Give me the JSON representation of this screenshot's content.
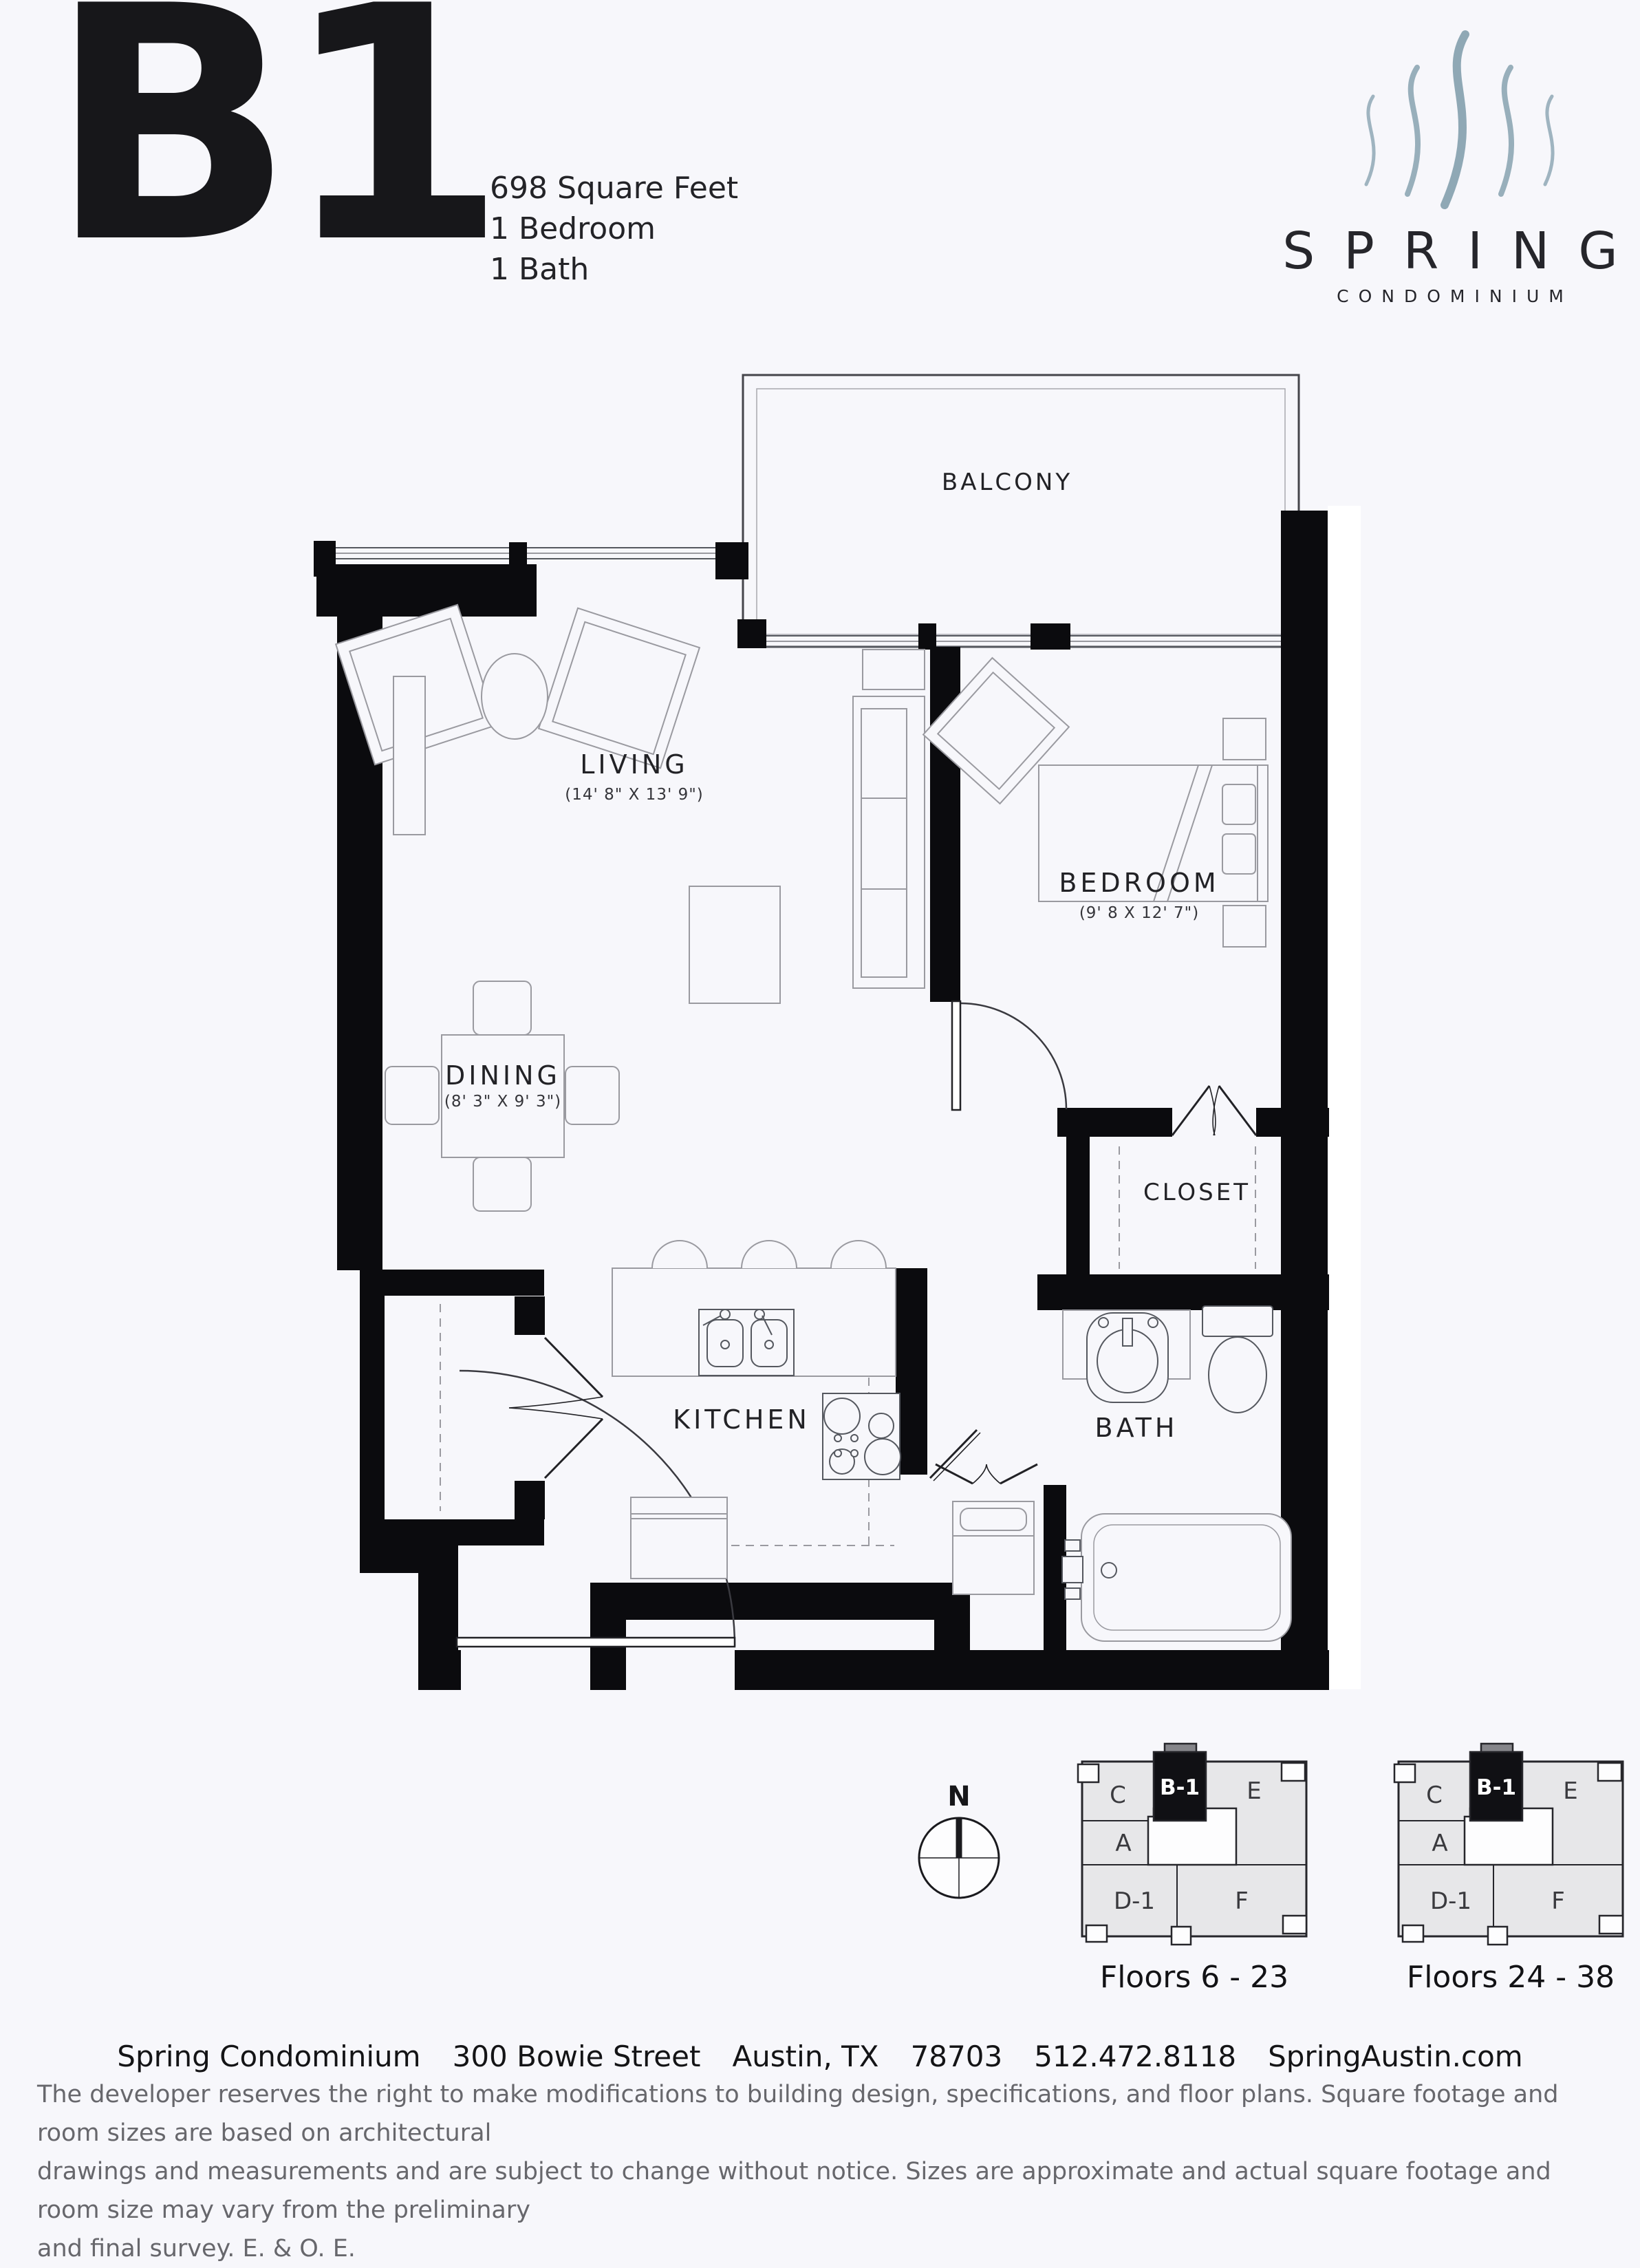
{
  "header": {
    "plan_code": "B1",
    "stats": [
      "698 Square Feet",
      "1 Bedroom",
      "1 Bath"
    ]
  },
  "logo": {
    "brand": "SPRING",
    "subtitle": "CONDOMINIUM",
    "wave_color": "#8fa8b5"
  },
  "floor_plan": {
    "rooms": [
      {
        "name": "BALCONY",
        "dims": ""
      },
      {
        "name": "LIVING",
        "dims": "(14' 8\" X 13' 9\")"
      },
      {
        "name": "BEDROOM",
        "dims": "(9' 8 X 12' 7\")"
      },
      {
        "name": "DINING",
        "dims": "(8' 3\" X 9' 3\")"
      },
      {
        "name": "CLOSET",
        "dims": ""
      },
      {
        "name": "KITCHEN",
        "dims": ""
      },
      {
        "name": "BATH",
        "dims": ""
      }
    ]
  },
  "compass": {
    "label": "N"
  },
  "key_plans": [
    {
      "caption": "Floors 6 - 23",
      "highlighted_unit": "B-1",
      "units": [
        "C",
        "B-1",
        "E",
        "A",
        "D-1",
        "F"
      ]
    },
    {
      "caption": "Floors 24 - 38",
      "highlighted_unit": "B-1",
      "units": [
        "C",
        "B-1",
        "E",
        "A",
        "D-1",
        "F"
      ]
    }
  ],
  "footer": {
    "address_parts": [
      "Spring Condominium",
      "300 Bowie Street",
      "Austin, TX",
      "78703",
      "512.472.8118",
      "SpringAustin.com"
    ],
    "disclaimer_lines": [
      "The developer reserves the right to make modifications to building design, specifications, and floor plans. Square footage and room sizes are based on architectural",
      "drawings and measurements and are subject to change without notice. Sizes are approximate and actual square footage and room size may vary from the preliminary",
      "and final survey. E. & O. E."
    ]
  },
  "colors": {
    "wall": "#0b0b0e",
    "line": "#55585f",
    "furniture": "#9a9aa0",
    "accent": "#8fa8b5",
    "keyplan_fill": "#e7e7e9",
    "keyplan_stub": "#85858a",
    "background": "#f7f7fb",
    "text": "#1f1f23",
    "muted": "#67676c"
  }
}
